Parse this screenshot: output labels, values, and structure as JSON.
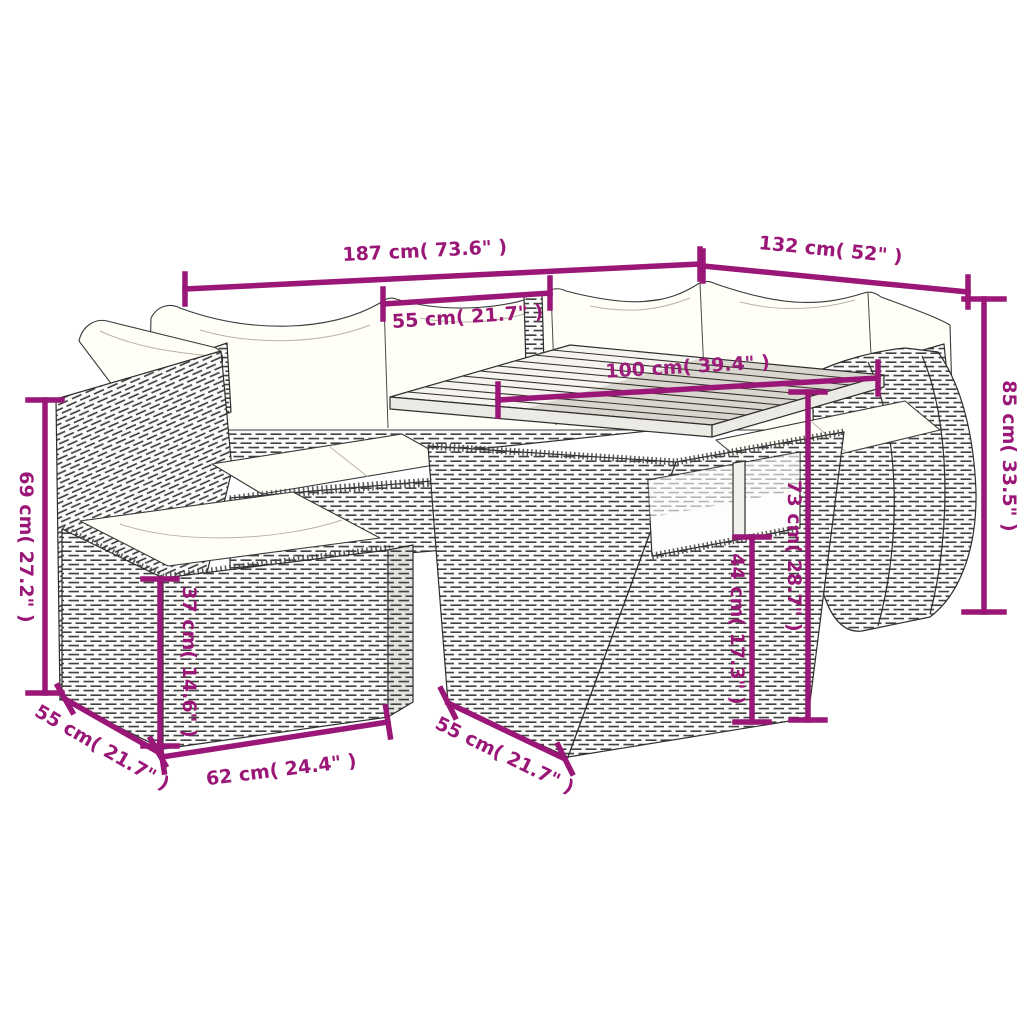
{
  "diagram": {
    "subject": "Poly rattan garden lounge set with cushions, dining table and footstool — dimension drawing",
    "accent_color": "#9a1677",
    "measurements": {
      "sofa_left_width": "187 cm( 73.6\" )",
      "sofa_right_width": "132 cm( 52\" )",
      "back_cushion_width": "55 cm( 21.7\" )",
      "table_length": "100 cm( 39.4\" )",
      "total_height": "85 cm( 33.5\" )",
      "left_back_height": "69 cm( 27.2\" )",
      "table_height": "73 cm( 28.7\" )",
      "table_clearance_height": "44 cm( 17.3\" )",
      "footstool_height": "37 cm( 14.6\" )",
      "footstool_depth": "55 cm( 21.7\" )",
      "footstool_width": "62 cm( 24.4\" )",
      "table_depth": "55 cm( 21.7\" )"
    }
  }
}
